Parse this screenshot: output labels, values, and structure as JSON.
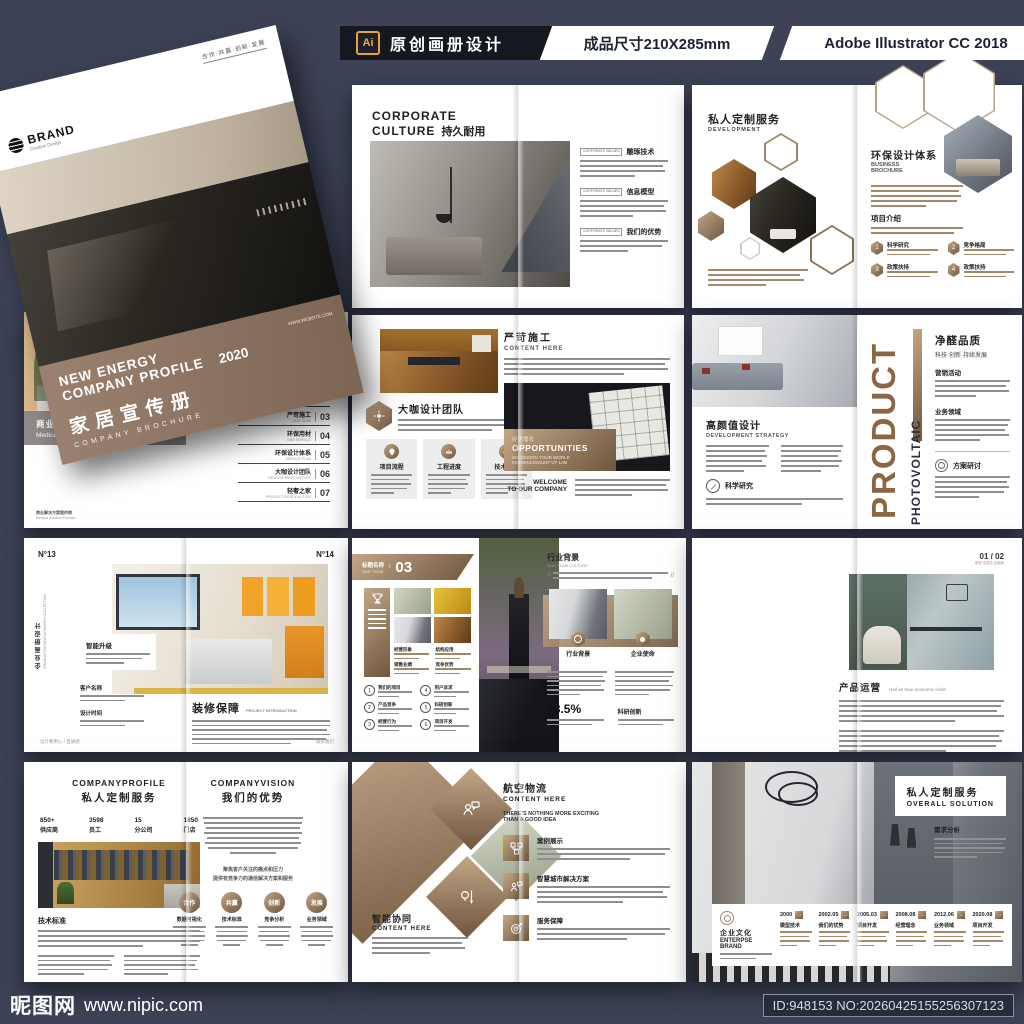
{
  "header": {
    "ai_badge": "Ai",
    "title": "原创画册设计",
    "size_label": "成品尺寸210X285mm",
    "software": "Adobe Illustrator CC 2018"
  },
  "footer": {
    "site_name": "昵图网",
    "site_url": "www.nipic.com",
    "id_text": "ID:948153 NO:20260425155256307123"
  },
  "colors": {
    "accent_brown": "#8d7361",
    "dark_navy": "#3d4257",
    "bar_black": "#16181f",
    "badge_orange": "#e8a33d"
  },
  "cover": {
    "brand": "BRAND",
    "brand_sub": "Creative Design",
    "slogan": "合作·共赢·创新·发展",
    "title_line1": "NEW ENERGY",
    "title_line2": "COMPANY PROFILE",
    "year": "2020",
    "cn_title": "家居宣传册",
    "en_sub": "COMPANY BROCHURE",
    "website": "WWW.WEBSITE.COM"
  },
  "intro": {
    "caption_cn": "商业应用解决方案",
    "caption_en": "Medical Solution Provider",
    "foot_cn": "商业解决方案提供商",
    "foot_en": "Medical Solution Provider",
    "directory_title": "DIRECTORY",
    "items": [
      {
        "num": "01",
        "cn": "环保用材",
        "en": "ABOUT US"
      },
      {
        "num": "02",
        "cn": "全屋品质整装",
        "en": "COMPANY PROFILE"
      },
      {
        "num": "03",
        "cn": "严苛施工",
        "en": "OUR TEAM"
      },
      {
        "num": "04",
        "cn": "环保用材",
        "en": "OUR SERVICE"
      },
      {
        "num": "05",
        "cn": "环保设计体系",
        "en": "SERVICE PLAN"
      },
      {
        "num": "06",
        "cn": "大咖设计团队",
        "en": "DEVELOPMENT HISTORY"
      },
      {
        "num": "07",
        "cn": "轻奢之家",
        "en": "PRODUCT INTRODUCTION"
      }
    ]
  },
  "culture": {
    "title_en1": "CORPORATE",
    "title_en2": "CULTURE",
    "title_cn": "持久耐用",
    "tag": "CORPORATE VALUES",
    "section1": "雕琢技术",
    "section2": "信息模型",
    "section3": "我们的优势"
  },
  "hexdev": {
    "left_title_cn": "私人定制服务",
    "left_title_en": "DEVELOPMENT",
    "right_title_cn": "环保设计体系",
    "right_sub1": "BUSINESS",
    "right_sub2": "BROCHURE",
    "section": "项目介绍",
    "n1_num": "1",
    "n1": "科学研究",
    "n2_num": "2",
    "n2": "竞争格局",
    "n3_num": "3",
    "n3": "政策扶持",
    "n4_num": "4",
    "n4": "政策扶持"
  },
  "team": {
    "heading": "大咖设计团队",
    "card1": "项目流程",
    "card2": "工程进度",
    "card3": "技术标准",
    "right_title_cn": "严苛施工",
    "right_title_en": "CONTENT HERE",
    "overlay_cn": "经济增长",
    "overlay_en": "OPPORTUNITIES",
    "overlay_sub1": "WE DESIGN YOUR WORLD",
    "overlay_sub2": "MINIMINCIDOUNT UT LAB",
    "welcome1": "WELCOME",
    "welcome2": "TO OUR COMPANY"
  },
  "product": {
    "left_title_cn": "高颜值设计",
    "left_title_en": "DEVELOPMENT STRATEGY",
    "left_tag": "科学研究",
    "vertical_main": "PRODUCT",
    "vertical_sub": "PHOTOVOLTAIC",
    "right_title": "净醛品质",
    "right_sub": "科技·创新·持续发展",
    "section1": "营销活动",
    "section2": "业务领域",
    "right_tag": "方案研讨"
  },
  "no13": {
    "pageL": "N°13",
    "pageR": "N°14",
    "side_cn": "企业画册设计",
    "side_en": "GRADUATION DESIGN WORKS COLLECTION",
    "label1": "智能升级",
    "label2": "客户名称",
    "label3": "设计时间",
    "main_cn": "装修保障",
    "main_en": "PROJECT INTRODUCTION",
    "foot_left": "设计要用心 / 显质感",
    "foot_right": "联系我们"
  },
  "ourteam": {
    "ribbon_cn": "标题名称",
    "ribbon_en": "OUR TEAM",
    "ribbon_num": "03",
    "grid1": "经营形象",
    "grid2": "结构应用",
    "grid3": "销售业绩",
    "grid4": "竞争优势",
    "items": [
      {
        "n": "1",
        "t": "我们的项目"
      },
      {
        "n": "2",
        "t": "产品竞争"
      },
      {
        "n": "3",
        "t": "经营行为"
      },
      {
        "n": "4",
        "t": "用户诉求"
      },
      {
        "n": "5",
        "t": "科研创新"
      },
      {
        "n": "6",
        "t": "项目开发"
      }
    ],
    "right_title_cn": "行业背景",
    "right_title_en": "OUR TEAM CULTURE",
    "card1": "行业背景",
    "card2": "企业使命",
    "stat": "98.5%",
    "stat_label": "科研创新"
  },
  "drawers": {
    "col1": "服务运维",
    "col2": "品牌营销",
    "col3": "技术标准",
    "page_no": "01 / 02",
    "page_no_sub": "家居·品质生活画册",
    "right_title": "产品运营",
    "right_sub": "Half an hour economic circle"
  },
  "profile": {
    "left_en": "COMPANYPROFILE",
    "left_cn": "私人定制服务",
    "stats": [
      {
        "v": "850+",
        "l": "供应商"
      },
      {
        "v": "3598",
        "l": "员工"
      },
      {
        "v": "15",
        "l": "分公司"
      },
      {
        "v": "1850",
        "l": "门店"
      }
    ],
    "section": "技术标准",
    "right_en": "COMPANYVISION",
    "right_cn": "我们的优势",
    "note1": "聚焦客户关注的痛点和压力",
    "note2": "提供有竞争力的通信解决方案和服务",
    "circles": [
      {
        "t": "合作",
        "s": "数据可视化"
      },
      {
        "t": "共赢",
        "s": "技术标准"
      },
      {
        "t": "创新",
        "s": "竞争分析"
      },
      {
        "t": "发展",
        "s": "业务领域"
      }
    ]
  },
  "smart": {
    "left_cn": "智能协同",
    "left_en": "CONTENT HERE",
    "right_cn": "航空物流",
    "right_en": "CONTENT HERE",
    "tagline1": "THERE'S NOTHING MORE EXCITING",
    "tagline2": "THAN A GOOD IDEA",
    "item1": "案例展示",
    "item2": "智慧城市解决方案",
    "item3": "服务保障"
  },
  "overall": {
    "title_cn": "私人定制服务",
    "title_en": "OVERALL SOLUTION",
    "tag": "需求分析",
    "brand_cn": "企业文化",
    "brand_en1": "ENTERPSE",
    "brand_en2": "BRAND",
    "timeline": [
      {
        "y": "2000",
        "l": "模型技术"
      },
      {
        "y": "2002.05",
        "l": "我们的优势"
      },
      {
        "y": "2005.03",
        "l": "项目开发"
      },
      {
        "y": "2008.08",
        "l": "经营理念"
      },
      {
        "y": "2012.06",
        "l": "业务领域"
      },
      {
        "y": "2020.08",
        "l": "项目开发"
      }
    ]
  }
}
